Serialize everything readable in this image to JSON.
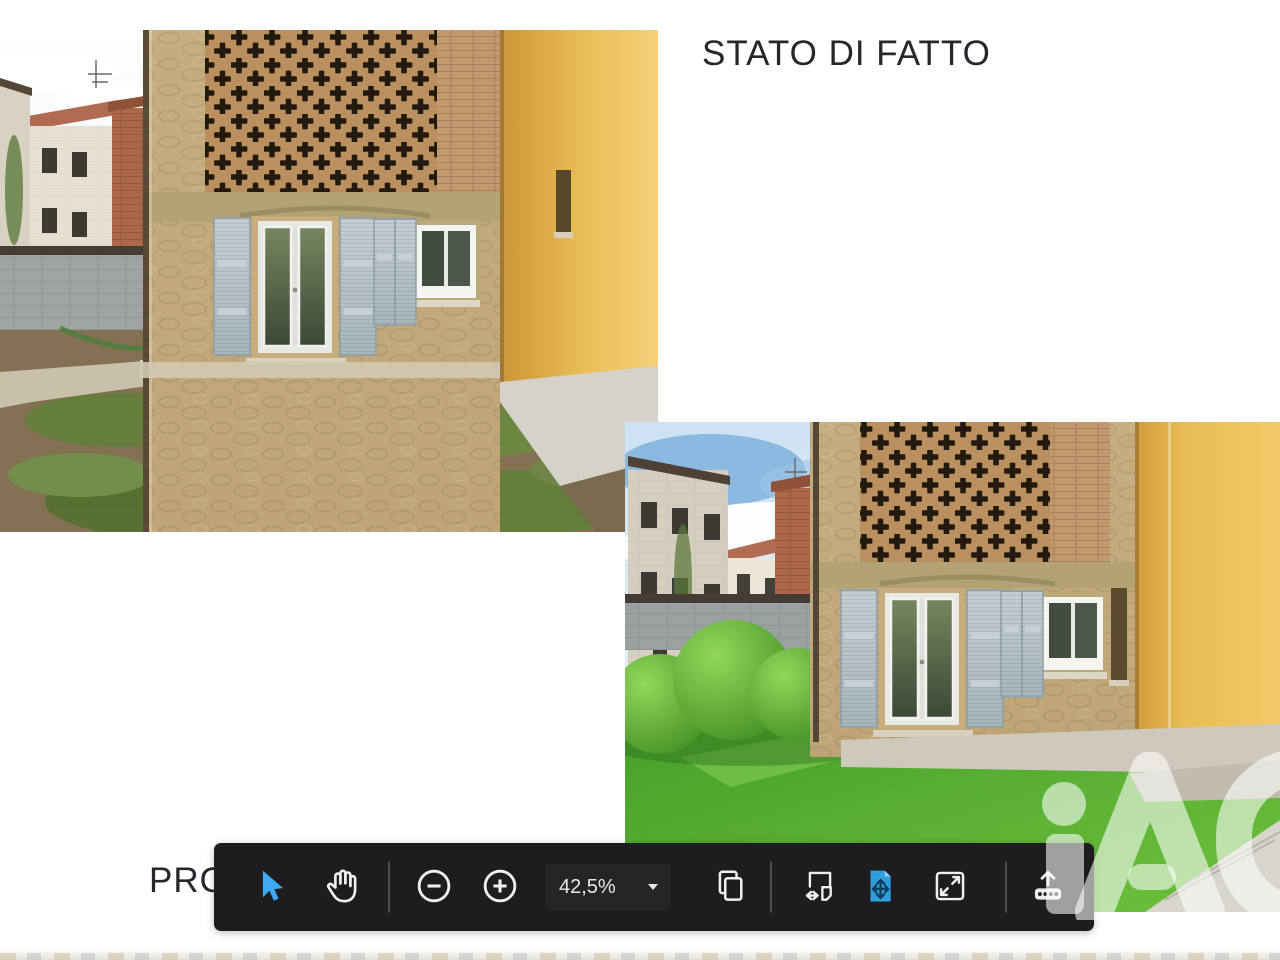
{
  "page": {
    "background": "#ffffff",
    "heading_top": "STATO DI FATTO",
    "heading_bottom": "PRO",
    "watermark_text": "iAD"
  },
  "toolbar": {
    "zoom_level": "42,5%",
    "background": "#1d1d1f",
    "accent_blue": "#3fa9f5",
    "active_tool_blue": "#2f9fdc",
    "tools": [
      {
        "id": "select",
        "icon": "cursor-icon",
        "active": true
      },
      {
        "id": "pan",
        "icon": "hand-icon",
        "active": false
      },
      {
        "id": "zoom-out",
        "icon": "minus-circle-icon",
        "active": false
      },
      {
        "id": "zoom-in",
        "icon": "plus-circle-icon",
        "active": false
      },
      {
        "id": "zoom-level-dropdown",
        "icon": "chevron-down-icon",
        "active": false
      },
      {
        "id": "copy-pages",
        "icon": "pages-icon",
        "active": false
      },
      {
        "id": "fit-width",
        "icon": "fit-width-icon",
        "active": false
      },
      {
        "id": "fit-page",
        "icon": "fit-page-icon",
        "active": true
      },
      {
        "id": "fullscreen",
        "icon": "expand-icon",
        "active": false
      },
      {
        "id": "upload",
        "icon": "upload-icon",
        "active": false
      }
    ]
  }
}
